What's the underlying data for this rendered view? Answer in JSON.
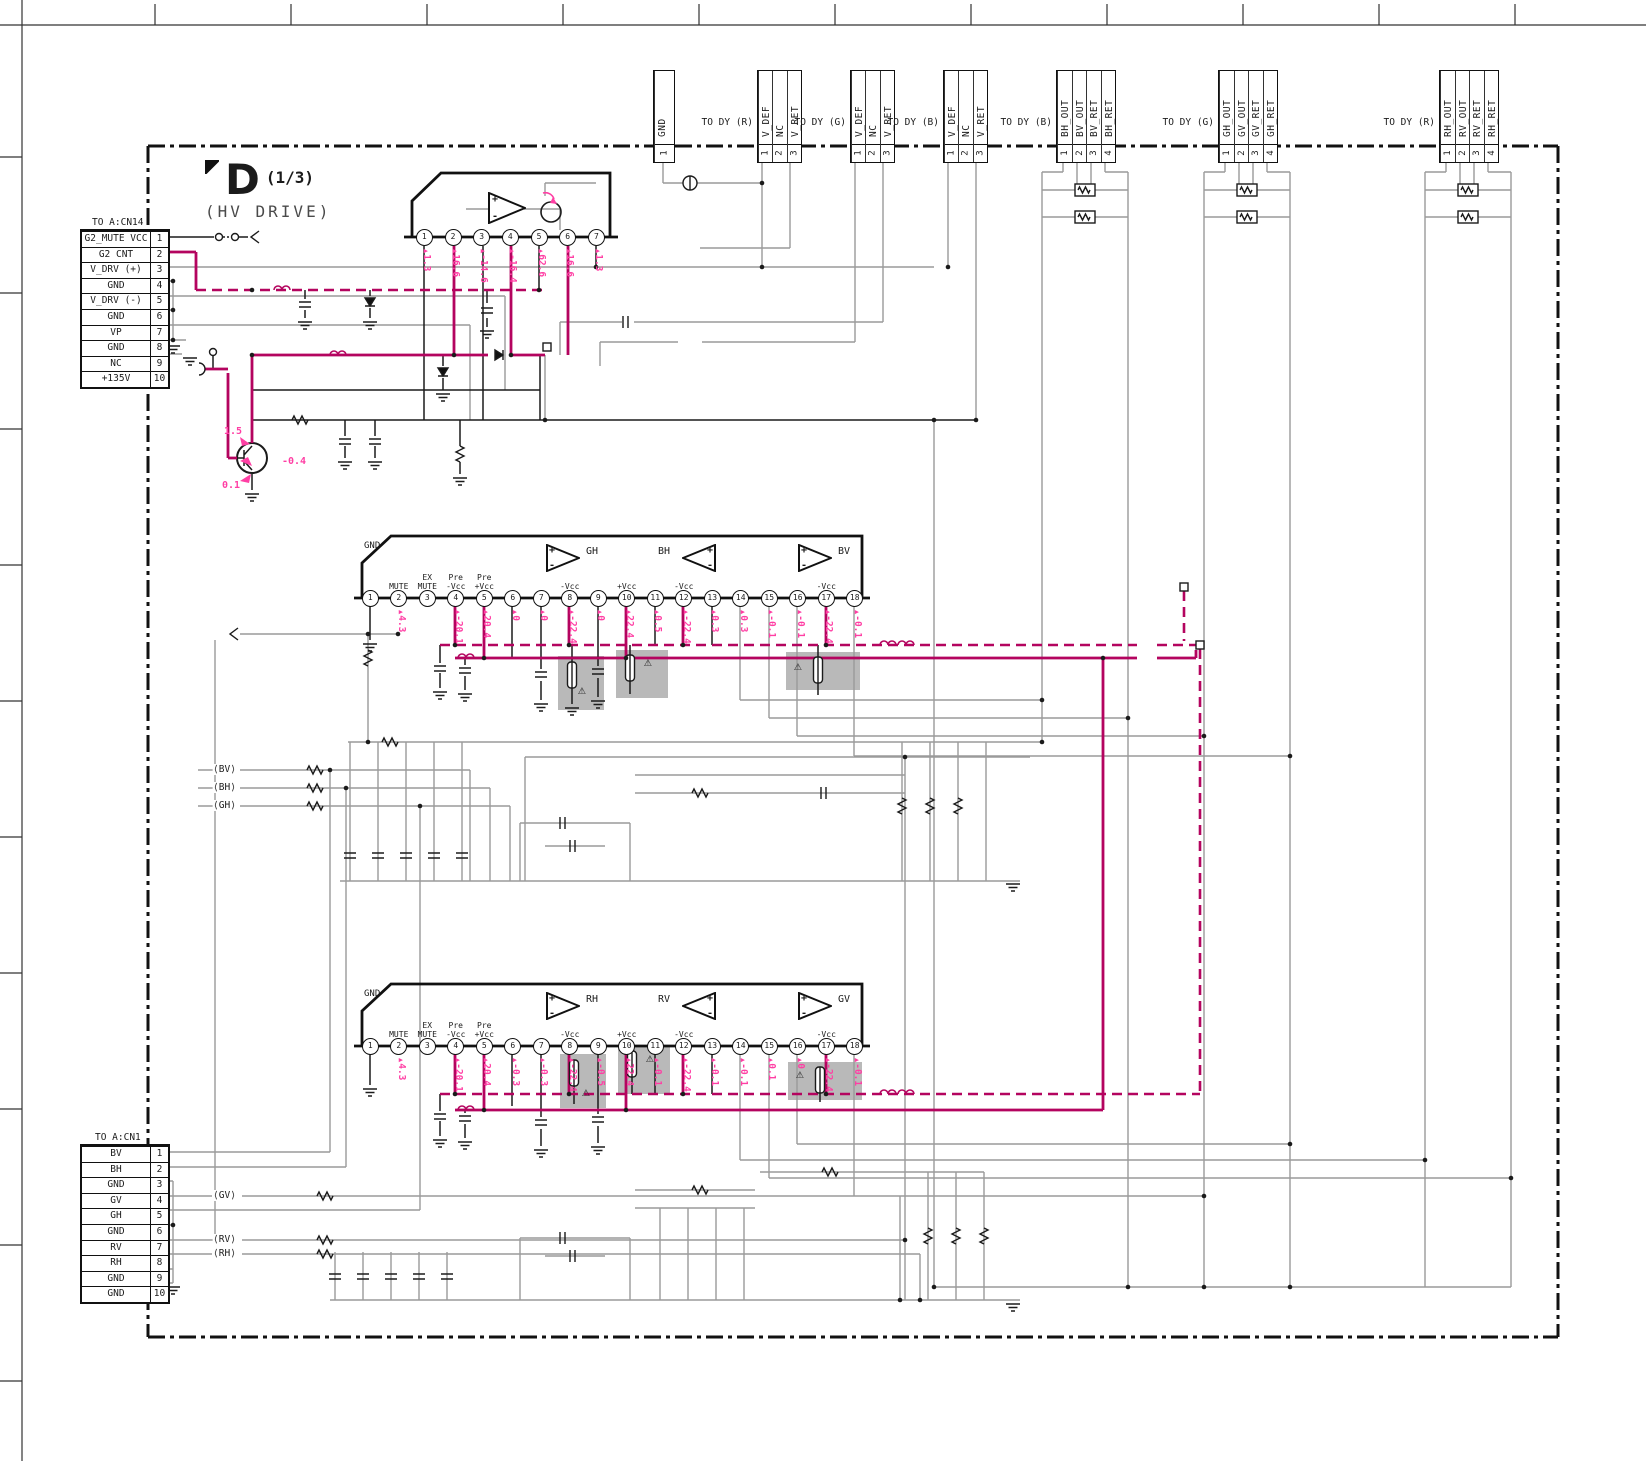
{
  "title": {
    "letter": "D",
    "fraction": "(1/3)",
    "subtitle": "(HV DRIVE)"
  },
  "connectors": {
    "cn14": {
      "caption": "TO A:CN14",
      "rows": [
        {
          "label": "G2_MUTE VCC",
          "pin": "1"
        },
        {
          "label": "G2 CNT",
          "pin": "2"
        },
        {
          "label": "V_DRV (+)",
          "pin": "3"
        },
        {
          "label": "GND",
          "pin": "4"
        },
        {
          "label": "V_DRV (-)",
          "pin": "5"
        },
        {
          "label": "GND",
          "pin": "6"
        },
        {
          "label": "VP",
          "pin": "7"
        },
        {
          "label": "GND",
          "pin": "8"
        },
        {
          "label": "NC",
          "pin": "9"
        },
        {
          "label": "+135V",
          "pin": "10"
        }
      ]
    },
    "cn1": {
      "caption": "TO A:CN1",
      "rows": [
        {
          "label": "BV",
          "pin": "1"
        },
        {
          "label": "BH",
          "pin": "2"
        },
        {
          "label": "GND",
          "pin": "3"
        },
        {
          "label": "GV",
          "pin": "4"
        },
        {
          "label": "GH",
          "pin": "5"
        },
        {
          "label": "GND",
          "pin": "6"
        },
        {
          "label": "RV",
          "pin": "7"
        },
        {
          "label": "RH",
          "pin": "8"
        },
        {
          "label": "GND",
          "pin": "9"
        },
        {
          "label": "GND",
          "pin": "10"
        }
      ]
    }
  },
  "top_connectors": [
    {
      "label": "",
      "pins": [
        {
          "name": "GND",
          "num": "1"
        }
      ]
    },
    {
      "label": "TO DY (R)",
      "pins": [
        {
          "name": "V_DEF",
          "num": "1"
        },
        {
          "name": "NC",
          "num": "2"
        },
        {
          "name": "V_RET",
          "num": "3"
        }
      ]
    },
    {
      "label": "TO DY (G)",
      "pins": [
        {
          "name": "V_DEF",
          "num": "1"
        },
        {
          "name": "NC",
          "num": "2"
        },
        {
          "name": "V_RET",
          "num": "3"
        }
      ]
    },
    {
      "label": "TO DY (B)",
      "pins": [
        {
          "name": "V_DEF",
          "num": "1"
        },
        {
          "name": "NC",
          "num": "2"
        },
        {
          "name": "V_RET",
          "num": "3"
        }
      ]
    },
    {
      "label": "TO DY (B)",
      "pins": [
        {
          "name": "BH_OUT",
          "num": "1"
        },
        {
          "name": "BV_OUT",
          "num": "2"
        },
        {
          "name": "BV_RET",
          "num": "3"
        },
        {
          "name": "BH_RET",
          "num": "4"
        }
      ]
    },
    {
      "label": "TO DY (G)",
      "pins": [
        {
          "name": "GH_OUT",
          "num": "1"
        },
        {
          "name": "GV_OUT",
          "num": "2"
        },
        {
          "name": "GV_RET",
          "num": "3"
        },
        {
          "name": "GH_RET",
          "num": "4"
        }
      ]
    },
    {
      "label": "TO DY (R)",
      "pins": [
        {
          "name": "RH_OUT",
          "num": "1"
        },
        {
          "name": "RV_OUT",
          "num": "2"
        },
        {
          "name": "RV_RET",
          "num": "3"
        },
        {
          "name": "RH_RET",
          "num": "4"
        }
      ]
    }
  ],
  "ic_top": {
    "pins": [
      {
        "num": "1",
        "v": "1.3"
      },
      {
        "num": "2",
        "v": "16.6"
      },
      {
        "num": "3",
        "v": "-14.6"
      },
      {
        "num": "4",
        "v": "-16.4"
      },
      {
        "num": "5",
        "v": "62.6"
      },
      {
        "num": "6",
        "v": "16.6"
      },
      {
        "num": "7",
        "v": "1.3"
      }
    ]
  },
  "ic_mid": {
    "gnd": "GND",
    "amps": [
      {
        "name": "GH"
      },
      {
        "name": "BH"
      },
      {
        "name": "BV"
      }
    ],
    "pins": [
      {
        "num": "1"
      },
      {
        "num": "2",
        "l2": "MUTE",
        "v": "4.3"
      },
      {
        "num": "3",
        "l1": "EX",
        "l2": "MUTE"
      },
      {
        "num": "4",
        "l1": "Pre",
        "l2": "-Vcc",
        "v": "-20.1"
      },
      {
        "num": "5",
        "l1": "Pre",
        "l2": "+Vcc",
        "v": "20.4"
      },
      {
        "num": "6",
        "v": "0"
      },
      {
        "num": "7",
        "v": "0"
      },
      {
        "num": "8",
        "l2": "-Vcc",
        "v": "-22.4"
      },
      {
        "num": "9",
        "v": "0"
      },
      {
        "num": "10",
        "l2": "+Vcc",
        "v": "22.4"
      },
      {
        "num": "11",
        "v": "0.5"
      },
      {
        "num": "12",
        "l2": "-Vcc",
        "v": "-22.4"
      },
      {
        "num": "13",
        "v": "0.3"
      },
      {
        "num": "14",
        "v": "0.3"
      },
      {
        "num": "15",
        "v": "-0.1"
      },
      {
        "num": "16",
        "v": "-0.1"
      },
      {
        "num": "17",
        "l2": "-Vcc",
        "v": "-22.4"
      },
      {
        "num": "18",
        "v": "-0.1"
      }
    ]
  },
  "ic_bot": {
    "gnd": "GND",
    "amps": [
      {
        "name": "RH"
      },
      {
        "name": "RV"
      },
      {
        "name": "GV"
      }
    ],
    "pins": [
      {
        "num": "1"
      },
      {
        "num": "2",
        "l2": "MUTE",
        "v": "4.3"
      },
      {
        "num": "3",
        "l1": "EX",
        "l2": "MUTE"
      },
      {
        "num": "4",
        "l1": "Pre",
        "l2": "-Vcc",
        "v": "-20.1"
      },
      {
        "num": "5",
        "l1": "Pre",
        "l2": "+Vcc",
        "v": "20.4"
      },
      {
        "num": "6",
        "v": "-0.3"
      },
      {
        "num": "7",
        "v": "-0.3"
      },
      {
        "num": "8",
        "l2": "-Vcc",
        "v": "-22.4"
      },
      {
        "num": "9",
        "v": "-0.5"
      },
      {
        "num": "10",
        "l2": "+Vcc",
        "v": "22.4"
      },
      {
        "num": "11",
        "v": "-0.1"
      },
      {
        "num": "12",
        "l2": "-Vcc",
        "v": "-22.4"
      },
      {
        "num": "13",
        "v": "-0.1"
      },
      {
        "num": "14",
        "v": "-0.1"
      },
      {
        "num": "15",
        "v": "0.1"
      },
      {
        "num": "16",
        "v": "0"
      },
      {
        "num": "17",
        "l2": "-Vcc",
        "v": "-22.4"
      },
      {
        "num": "18",
        "v": "-0.1"
      }
    ]
  },
  "transistor": {
    "vc": "1.5",
    "vb": "-0.4",
    "ve": "0.1"
  },
  "signal_tags": {
    "mid": [
      {
        "name": "BV"
      },
      {
        "name": "BH"
      },
      {
        "name": "GH"
      }
    ],
    "bottom": [
      {
        "name": "GV"
      },
      {
        "name": "RV"
      },
      {
        "name": "RH"
      }
    ]
  },
  "misc": {
    "plus": "+",
    "minus": "-",
    "warning": "⚠"
  },
  "colors": {
    "magenta": "#b4045f",
    "pink": "#ff3fa4",
    "gray_wire": "#9a9a9a",
    "black": "#1b1b1b",
    "box_gray": "#b9b9b9"
  }
}
